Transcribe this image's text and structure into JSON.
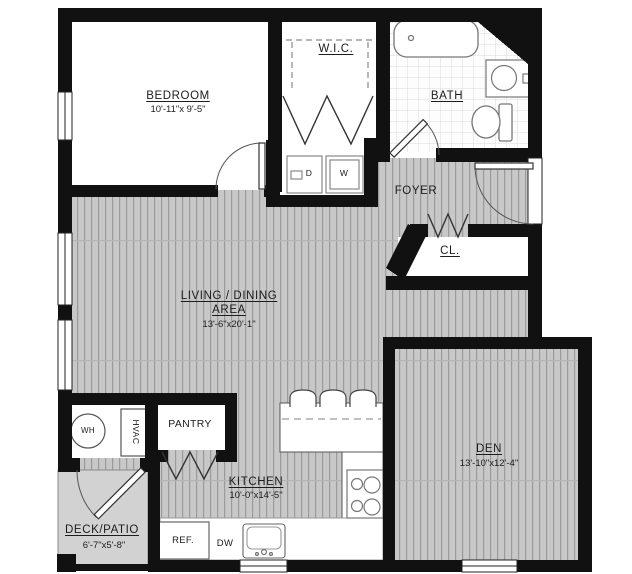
{
  "plan": {
    "rooms": {
      "bedroom": {
        "name": "BEDROOM",
        "dims": "10'-11\"x 9'-5\""
      },
      "wic": {
        "name": "W.I.C."
      },
      "bath": {
        "name": "BATH"
      },
      "foyer": {
        "name": "FOYER"
      },
      "closet": {
        "name": "CL."
      },
      "living": {
        "line1": "LIVING / DINING",
        "line2": "AREA",
        "dims": "13'-6\"x20'-1\""
      },
      "kitchen": {
        "name": "KITCHEN",
        "dims": "10'-0\"x14'-5\""
      },
      "den": {
        "name": "DEN",
        "dims": "13'-10\"x12'-4\""
      },
      "deck": {
        "name": "DECK/PATIO",
        "dims": "6'-7\"x5'-8\""
      },
      "pantry": {
        "name": "PANTRY"
      }
    },
    "appliances": {
      "water_heater": "WH",
      "hvac": "HVAC",
      "dryer": "D",
      "washer": "W",
      "refrigerator": "REF.",
      "dishwasher": "DW"
    },
    "colors": {
      "wall": "#111111",
      "wood_floor": "#c8c8c8",
      "wood_stripe": "#9b9b9b",
      "tile_line": "#dcdcdc",
      "deck_floor": "#d2d2d2"
    }
  }
}
